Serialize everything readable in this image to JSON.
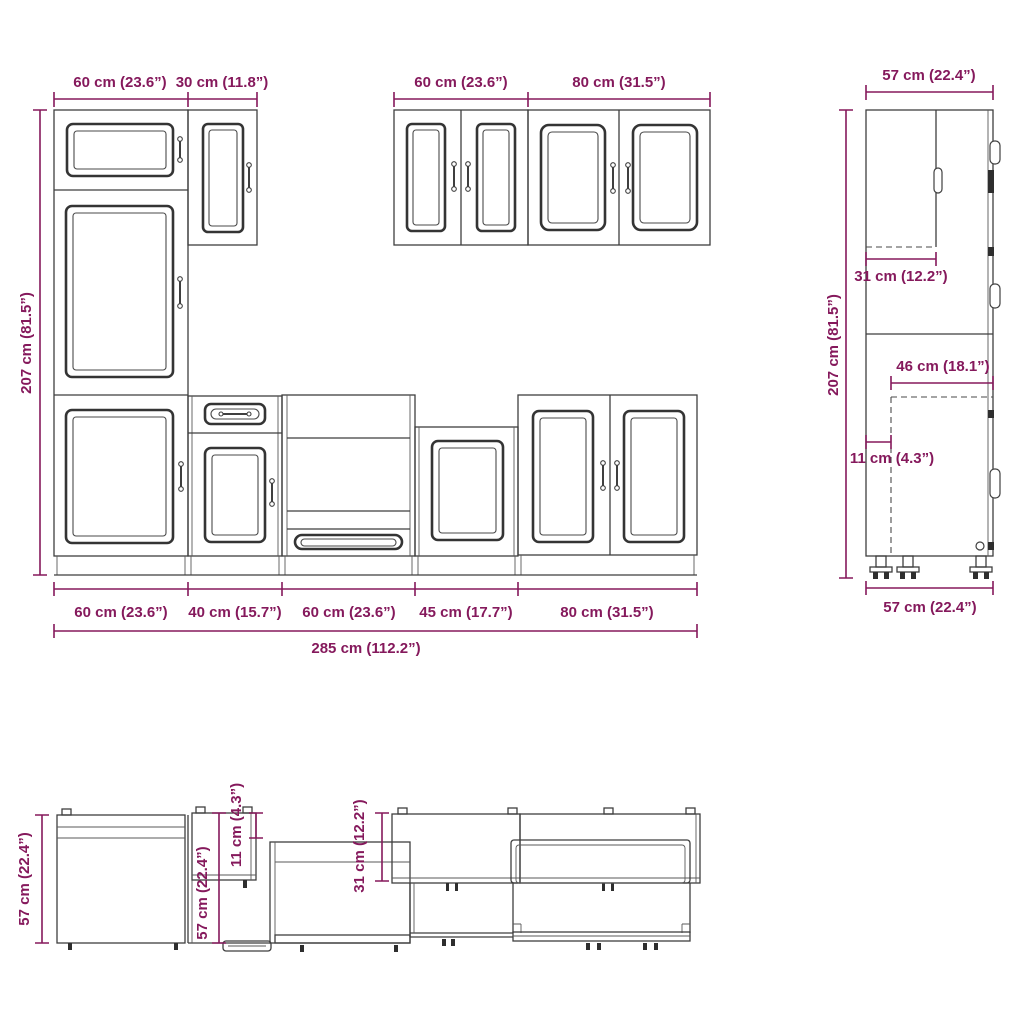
{
  "drawing": {
    "type": "kitchen-cabinet-set-technical-drawing",
    "colors": {
      "dimension_text": "#85195c",
      "line": "#3f3f3f",
      "background": "#ffffff"
    },
    "front": {
      "top_dimensions": [
        "60 cm (23.6”)",
        "30 cm (11.8”)",
        "60 cm (23.6”)",
        "80 cm (31.5”)"
      ],
      "height_dimension": "207 cm (81.5”)",
      "bottom_dimensions": [
        "60 cm (23.6”)",
        "40 cm (15.7”)",
        "60 cm (23.6”)",
        "45 cm (17.7”)",
        "80 cm (31.5”)"
      ],
      "total_dimension": "285 cm (112.2”)"
    },
    "side": {
      "width_top": "57 cm (22.4”)",
      "height_dimension": "207 cm (81.5”)",
      "wall_cabinet_depth": "31 cm (12.2”)",
      "interior_depth": "46 cm (18.1”)",
      "back_offset": "11 cm (4.3”)",
      "width_bottom": "57 cm (22.4”)"
    },
    "plan": {
      "depth_left": "57 cm (22.4”)",
      "depth_mid": "57 cm (22.4”)",
      "back_offset": "11 cm (4.3”)",
      "wall_cabinet_depth": "31 cm (12.2”)"
    }
  }
}
